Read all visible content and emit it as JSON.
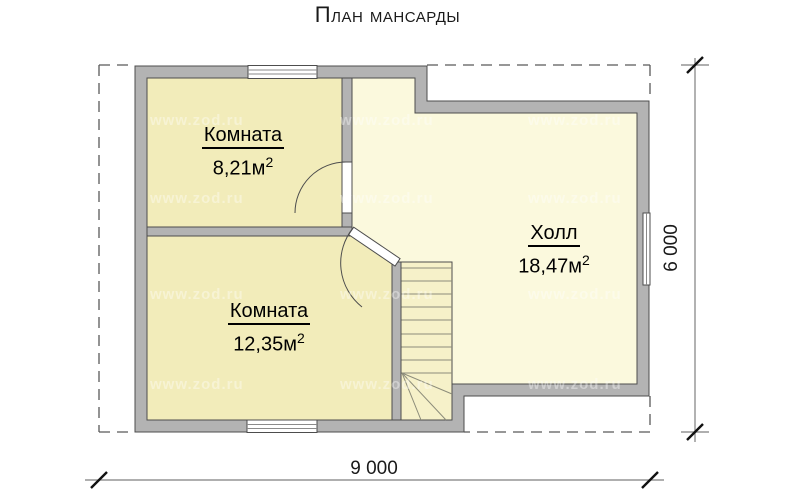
{
  "title": "План мансарды",
  "plan": {
    "rooms": [
      {
        "name": "Комната",
        "area": "8,21м",
        "area_sup": "2"
      },
      {
        "name": "Комната",
        "area": "12,35м",
        "area_sup": "2"
      },
      {
        "name": "Холл",
        "area": "18,47м",
        "area_sup": "2"
      }
    ],
    "dimensions": {
      "bottom": "9 000",
      "right": "6 000"
    }
  },
  "watermark": {
    "text": "www.zod.ru"
  },
  "colors": {
    "room_fill": "#f2ecba",
    "hall_fill": "#fbf9dd",
    "stairs_fill": "#f6f1c9",
    "wall_fill": "#b3b3b3",
    "wall_line": "#4d4d4d",
    "dash_line": "#595959",
    "dim_line": "#7f7f7f",
    "tick": "#111111"
  }
}
